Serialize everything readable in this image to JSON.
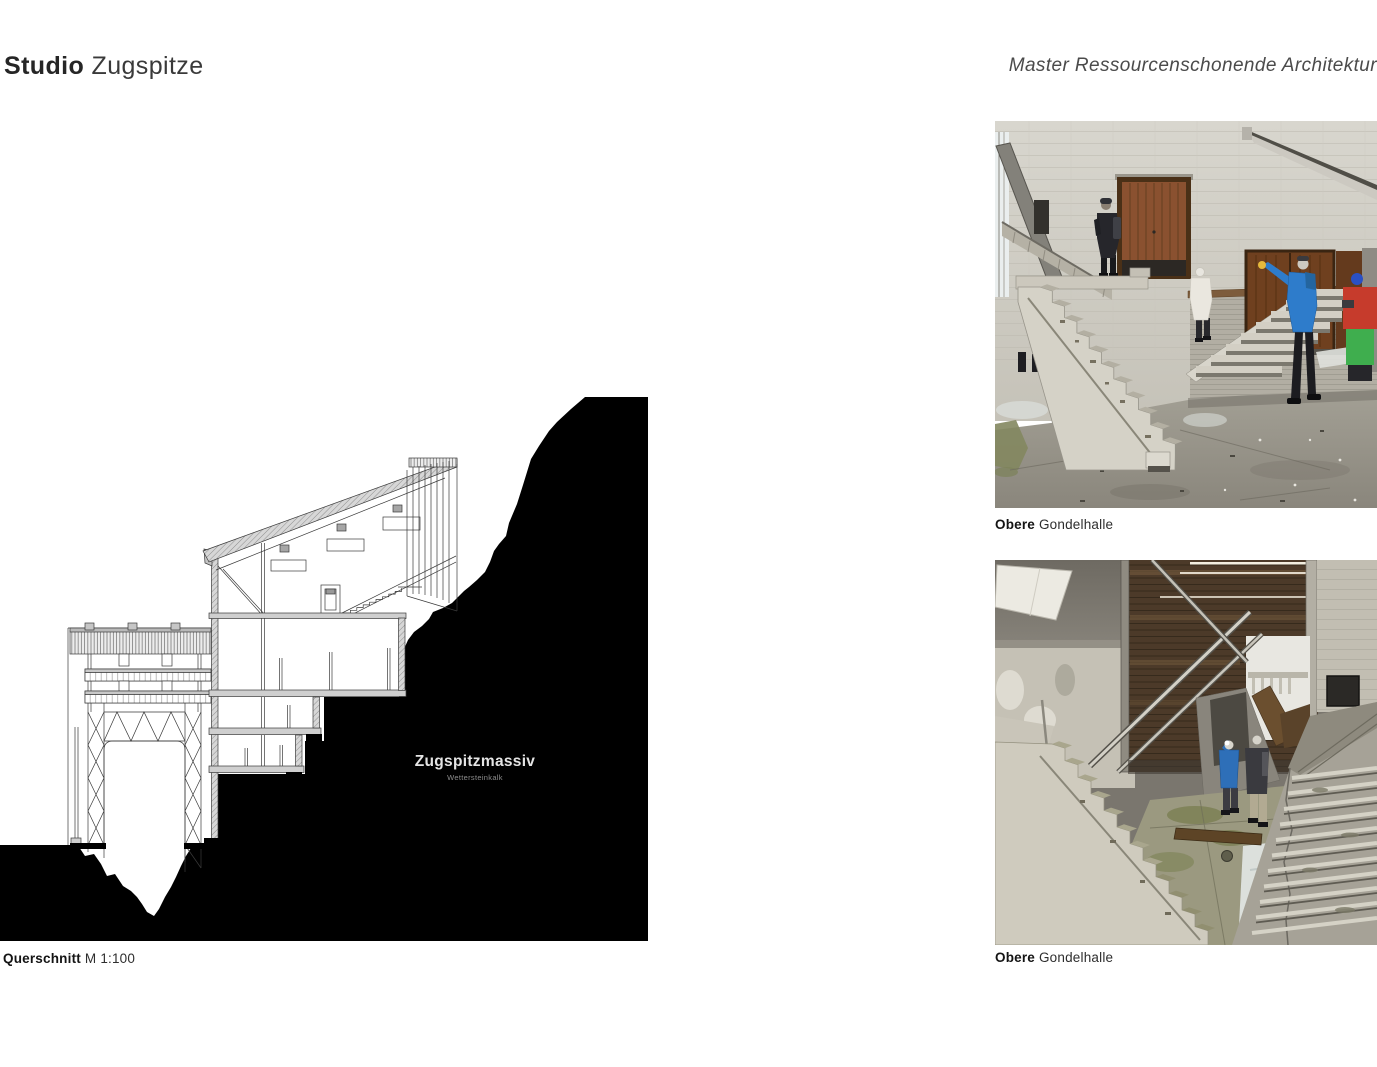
{
  "header": {
    "title_bold": "Studio",
    "title_light": " Zugspitze",
    "course": "Master Ressourcenschonende Architektur"
  },
  "drawing": {
    "massif_label": "Zugspitzmassiv",
    "massif_sublabel": "Wettersteinkalk",
    "caption_bold": "Querschnitt",
    "caption_rest": " M 1:100"
  },
  "photos": [
    {
      "caption_bold": "Obere",
      "caption_rest": " Gondelhalle"
    },
    {
      "caption_bold": "Obere",
      "caption_rest": " Gondelhalle"
    }
  ],
  "colors": {
    "page_bg": "#ffffff",
    "ink": "#2e2e2e",
    "rock_black": "#000000",
    "massif_label_color": "#e4e4e4",
    "massif_sublabel_color": "#8d8d8d"
  }
}
